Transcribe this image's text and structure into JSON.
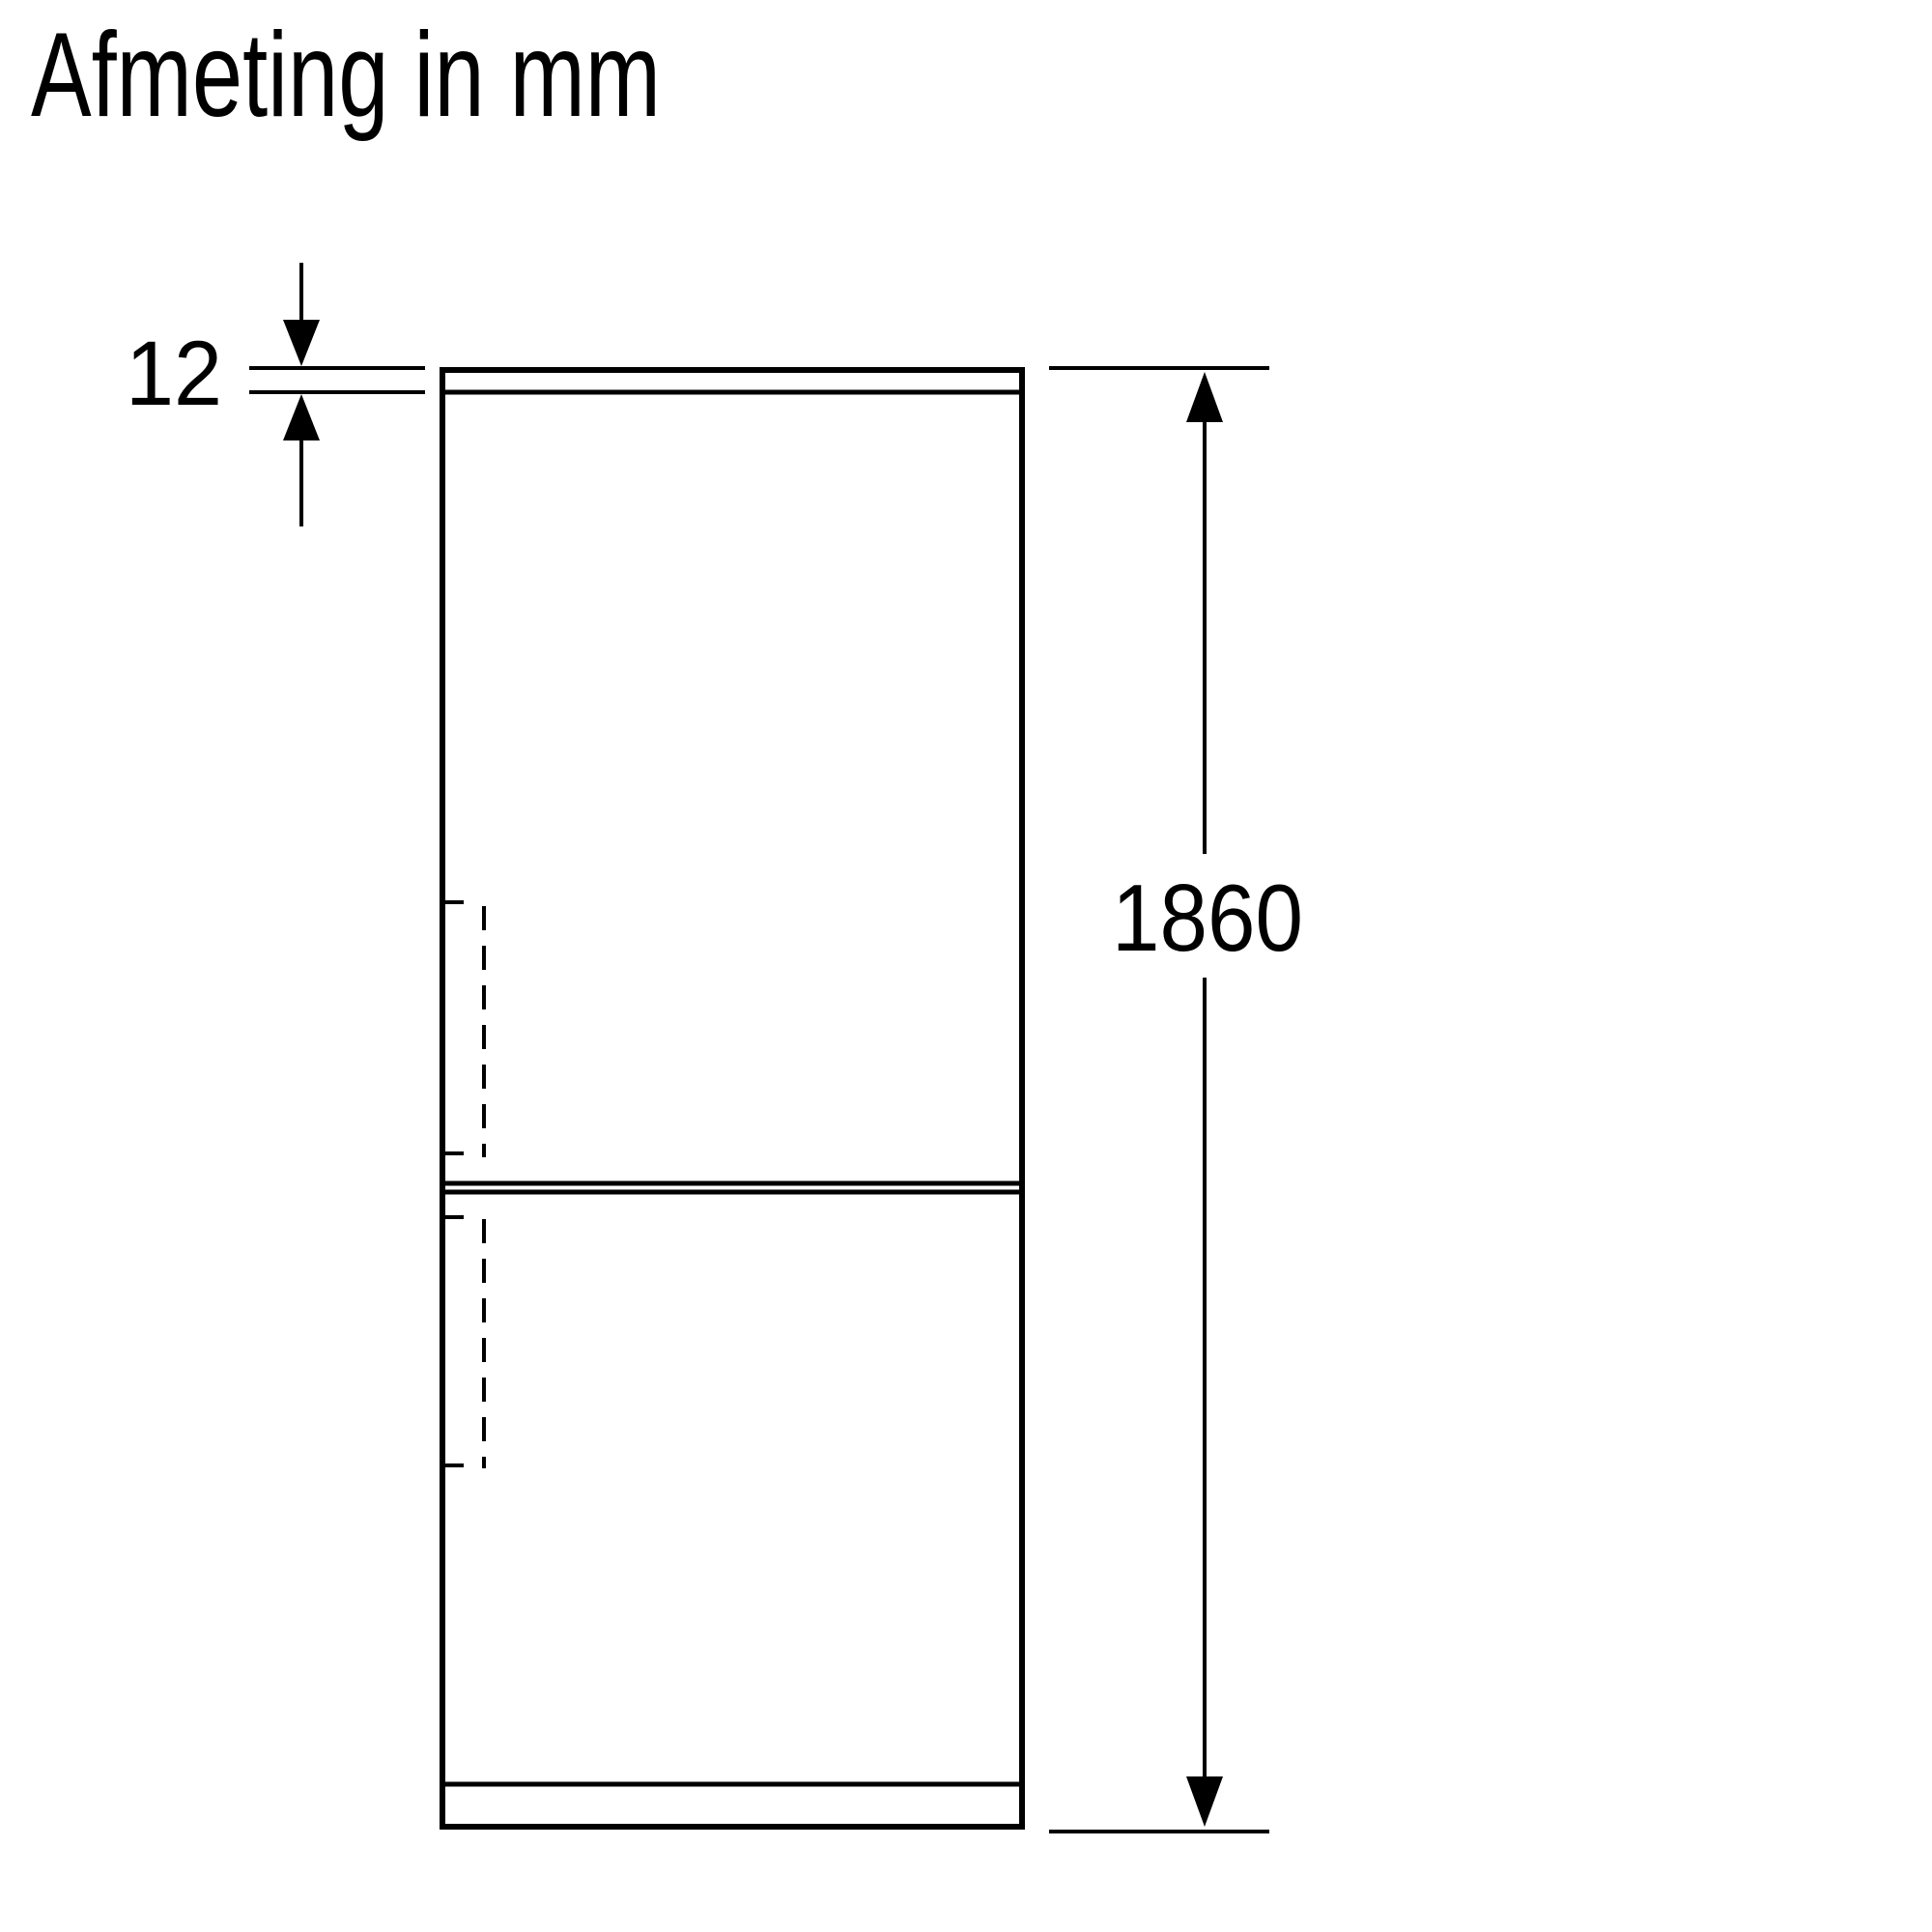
{
  "title": "Afmeting in mm",
  "diagram": {
    "type": "appliance-dimension-drawing",
    "subject": "fridge-freezer front view, two doors",
    "colors": {
      "line": "#000000",
      "background": "#ffffff"
    },
    "dimensions": {
      "top_panel_thickness": {
        "label": "12",
        "orientation": "vertical",
        "measures": "top panel thickness, arrows pointing inward from above and below"
      },
      "total_height": {
        "label": "1860",
        "orientation": "vertical",
        "measures": "total appliance height, double-headed arrow along right side"
      }
    }
  }
}
